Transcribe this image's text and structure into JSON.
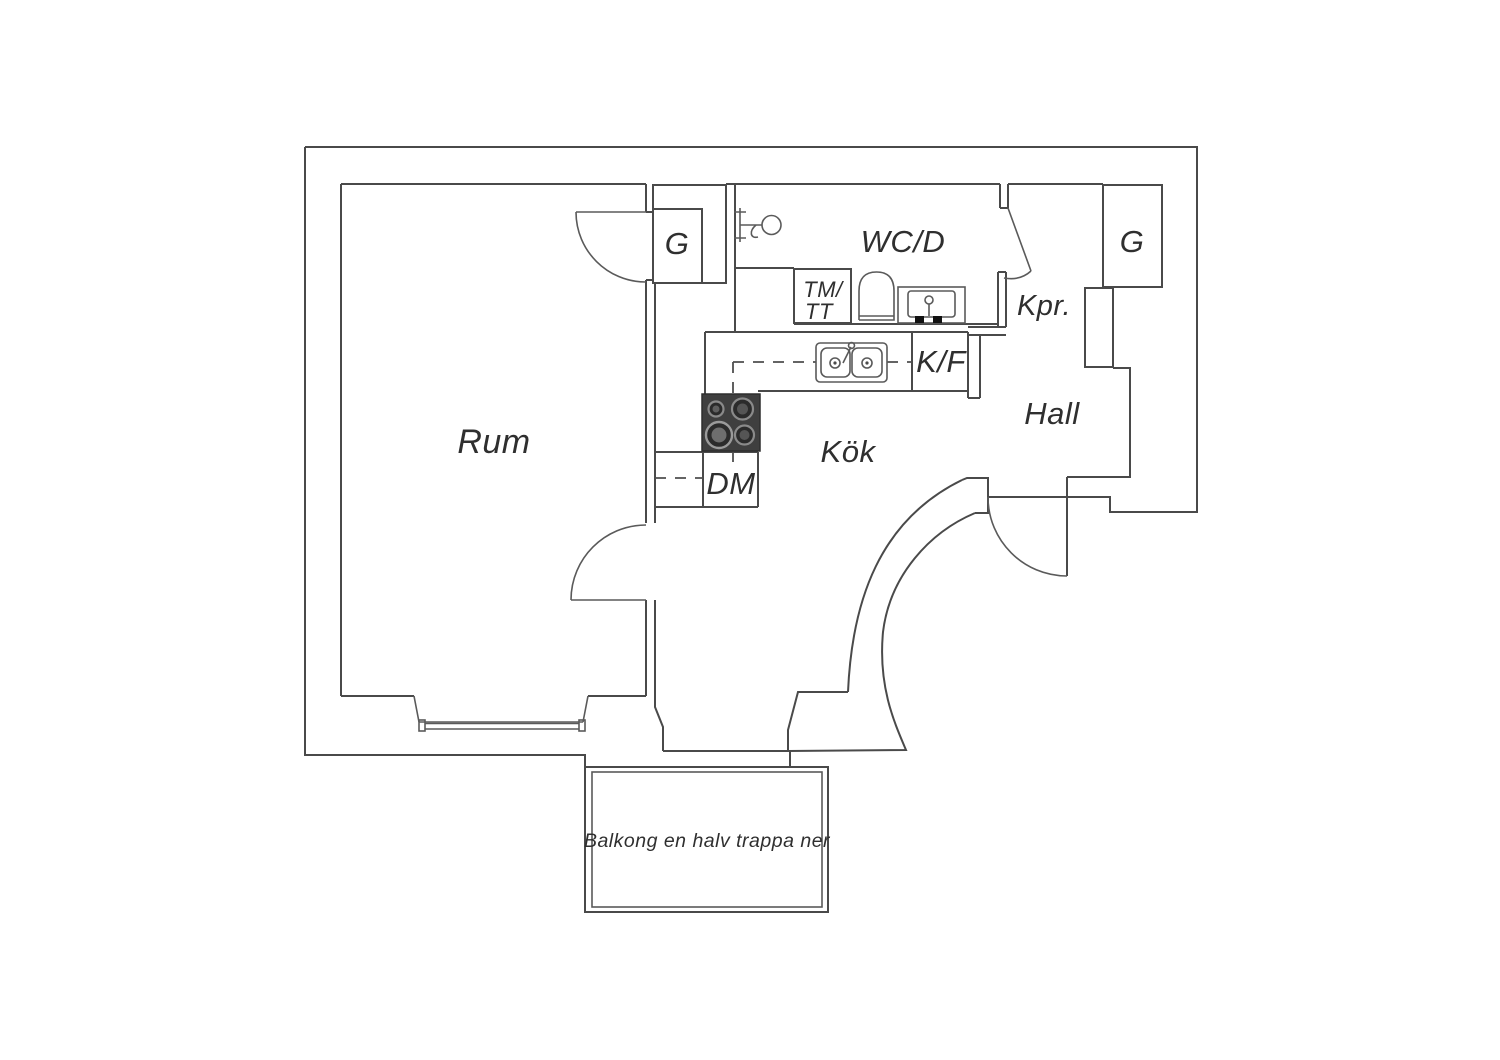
{
  "plan": {
    "type": "apartment-floor-plan",
    "language": "Swedish"
  },
  "colors": {
    "background": "#ffffff",
    "wall_line": "#4a4a4a",
    "text": "#2f2f2f",
    "stove_body": "#3f3f3f",
    "stove_burner_ring": "#9a9a9a",
    "stove_burner_fill": "#2b2b2b",
    "appliance_black": "#111111"
  },
  "rooms": {
    "rum": "Rum",
    "kok": "Kök",
    "hall": "Hall",
    "wc_d": "WC/D",
    "kpr": "Kpr.",
    "closet_left": "G",
    "closet_right": "G"
  },
  "fixtures": {
    "washer_dryer_line1": "TM/",
    "washer_dryer_line2": "TT",
    "fridge_freezer": "K/F",
    "dishwasher": "DM"
  },
  "annotations": {
    "balcony_note": "Balkong en halv trappa ner"
  }
}
